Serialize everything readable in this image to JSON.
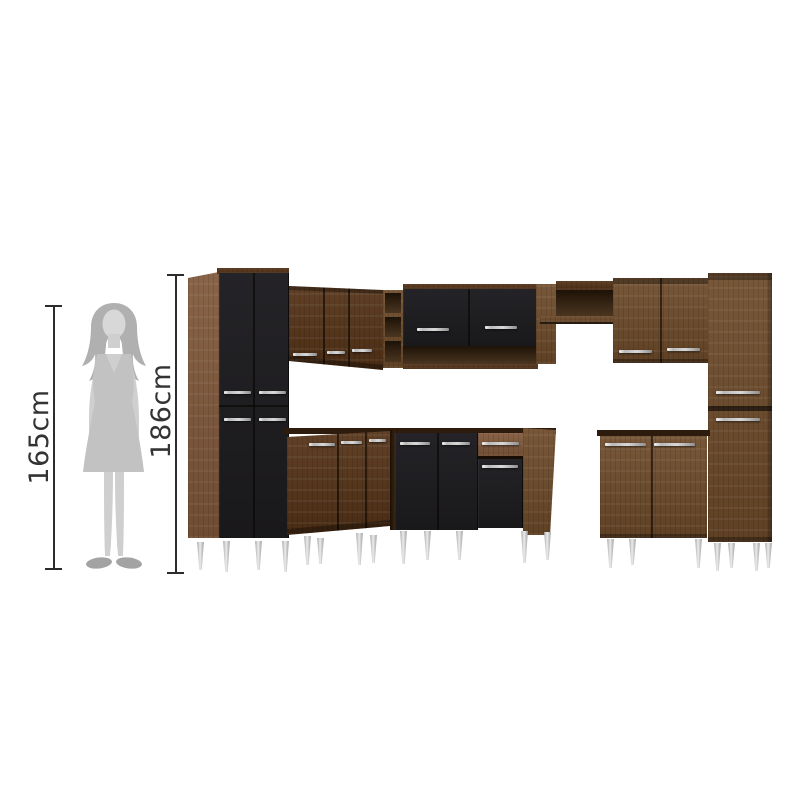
{
  "page": {
    "title": "kitchen-cabinet-set-dimension-diagram",
    "background": "#ffffff"
  },
  "annotations": {
    "person": {
      "label": "165cm"
    },
    "furniture": {
      "label": "186cm"
    }
  },
  "palette": {
    "dim-line": "#2c2c2c",
    "dim-text": "#333333",
    "wood": "#6e4b2a",
    "wood-dark": "#553317",
    "wood-deep": "#33200e",
    "wood-light": "#80583a",
    "black-door": "#1c1b1d",
    "niche": "#1d1207",
    "niche-light": "#4a3520",
    "handle": "#d8d8d8",
    "counter": "#2d1b0d",
    "leg-light": "#ececec",
    "leg-dark": "#8f8f8f",
    "sil-hair": "#b0b0b0",
    "sil-face": "#d8d8d8",
    "sil-skin": "#cfcfcf",
    "sil-dress": "#c2c2c2",
    "sil-shoes": "#a3a3a3"
  }
}
